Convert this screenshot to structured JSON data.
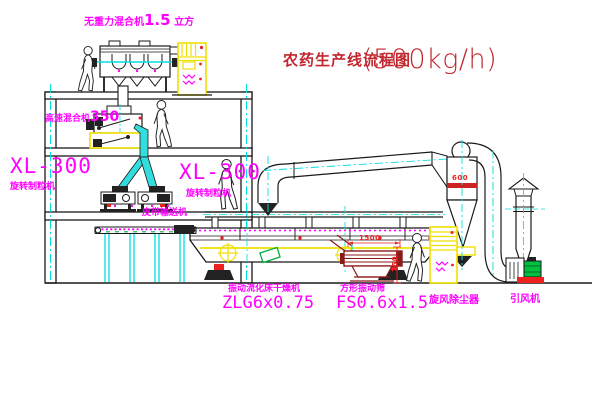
{
  "title": {
    "name": "农药生产线流程图",
    "capacity": "(500kg/h)"
  },
  "labels": {
    "gravity_mixer_name": "无重力混合机",
    "gravity_mixer_size": "1.5",
    "gravity_mixer_unit": "立方",
    "high_speed_mixer_name": "高速混合机",
    "high_speed_mixer_size": "350",
    "granulator_left_model": "XL-300",
    "granulator_left_name": "旋转制粒机",
    "granulator_right_model": "XL-300",
    "granulator_right_name": "旋转制粒机",
    "belt_conveyor": "皮带输送机",
    "dryer_name": "振动流化床干燥机",
    "dryer_model": "ZLG6x0.75",
    "sieve_name": "方形振动筛",
    "sieve_model": "FS0.6x1.5",
    "cyclone_name": "旋风除尘器",
    "fan_name": "引风机"
  },
  "dimensions": {
    "cyclone_diameter": "600",
    "sieve_length": "1500",
    "sieve_height": "750"
  },
  "colors": {
    "label_magenta": "#ff00ff",
    "title_red": "#c2262e",
    "dimension_red": "#ee2222",
    "centerline_cyan": "#00e0e0",
    "chute_cyan": "#33dddd",
    "cabinet_yellow": "#f0e000",
    "motor_green": "#00c040",
    "line_dark": "#1a1a1a",
    "sieve_dark_red": "#8b1a1a"
  }
}
